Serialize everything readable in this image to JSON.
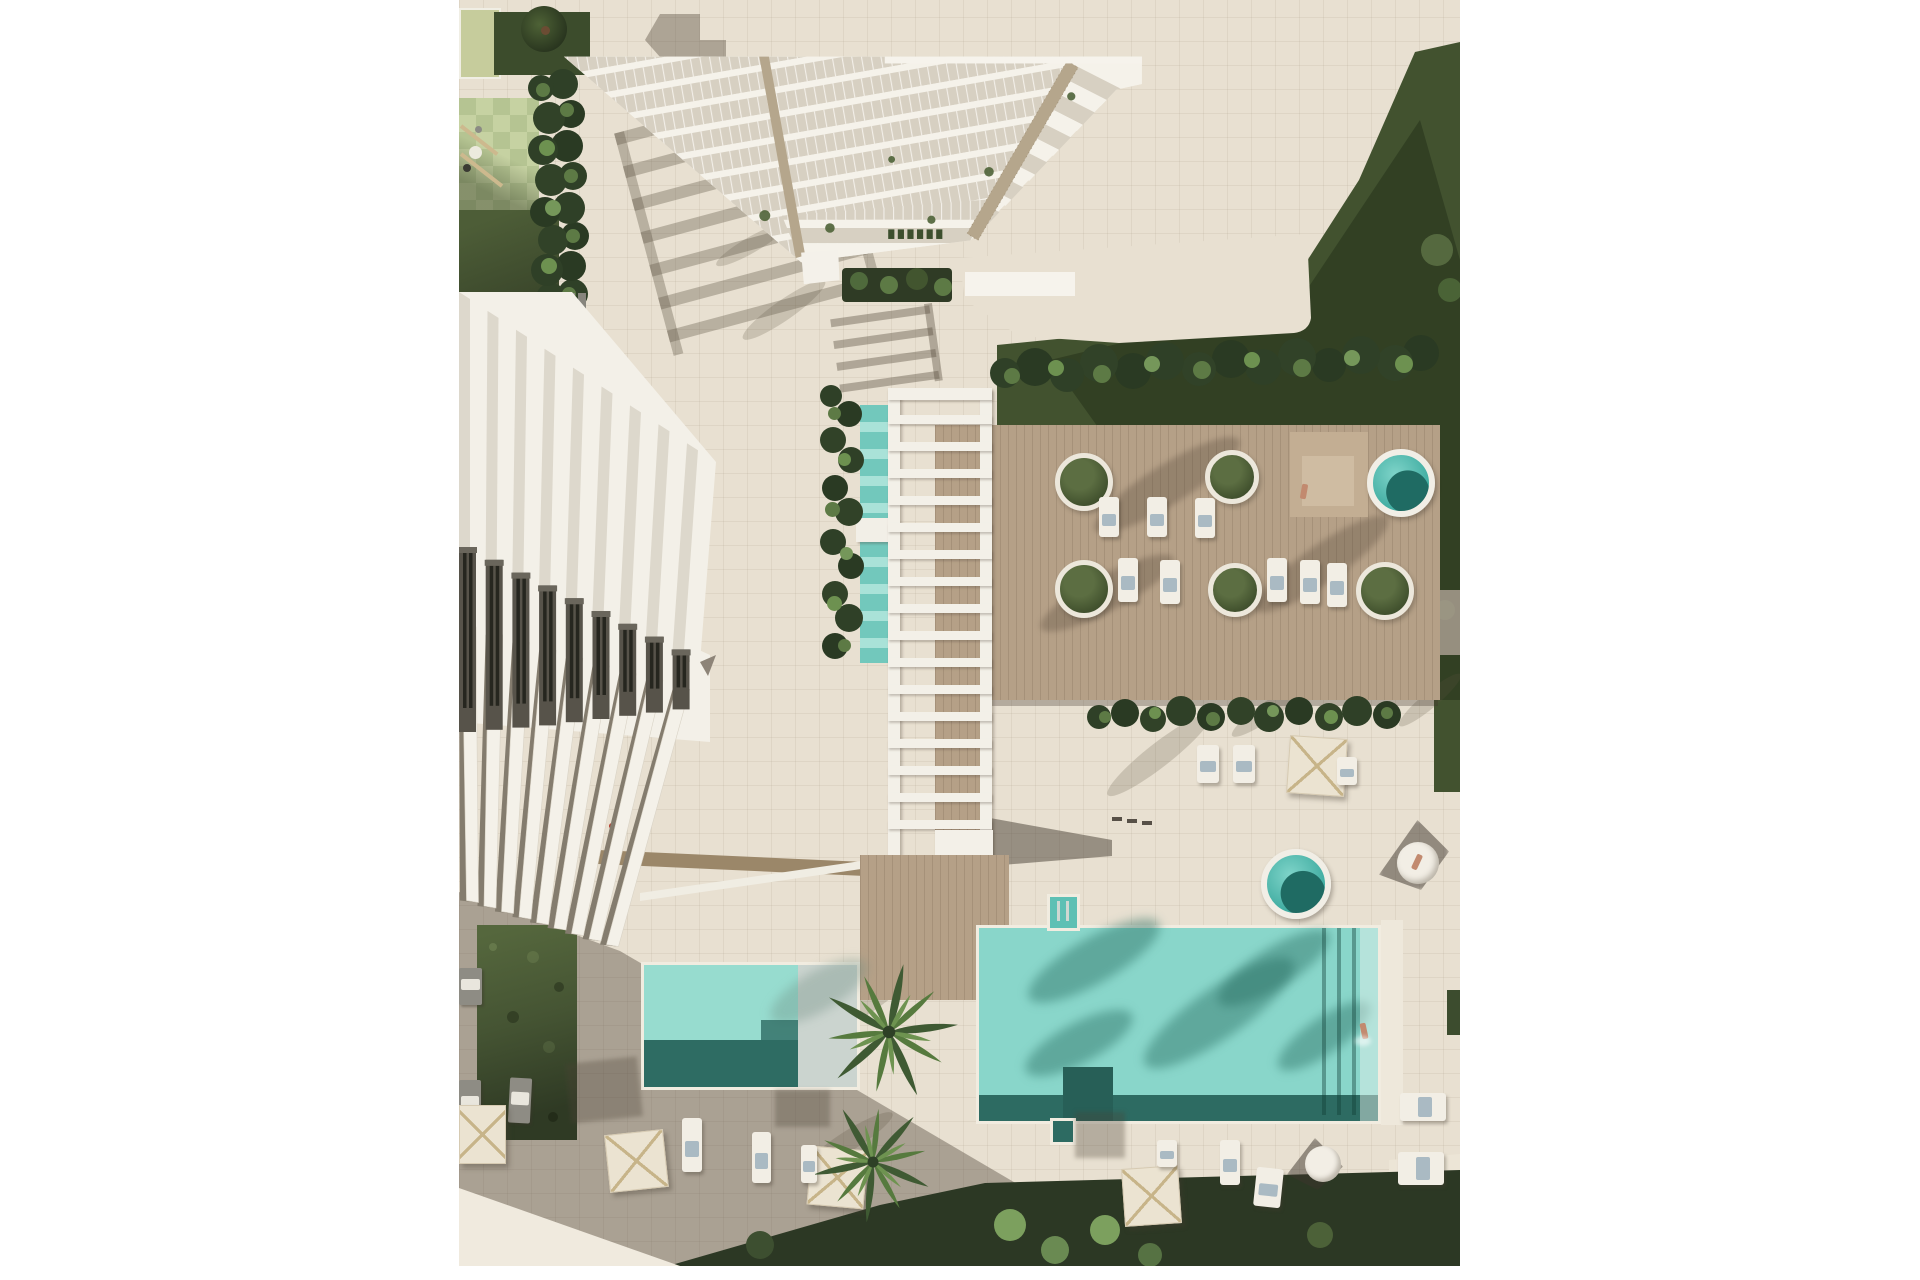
{
  "meta": {
    "type": "architectural-aerial-render",
    "description": "Top-down 3D visualization of a coastal residential complex: a white balconied tower (top), a diagonal row of white townhouses (left), a slatted pergola over a two-part lap pool (center), a wooden sun deck with round planters and plunge pools (right), a large turquoise swimming pool and a smaller kids pool (bottom), surrounded by gardens, palm trees, parasols and sun loungers.",
    "canvas": {
      "width": 1920,
      "height": 1280
    },
    "margins": "white vertical margins left and right, thin white strip at bottom"
  },
  "palette": {
    "page_background": "#ffffff",
    "paving": "#e8e0d1",
    "paving_grid": "#a89c88",
    "sunlit_path": "#f0eade",
    "cast_shadow": "#54483e",
    "deck_wood": "#b5a087",
    "path_wood": "#9b8769",
    "pool_turquoise": "#89d6ca",
    "pool_shadow_teal": "#2d6b62",
    "kids_pool": "#97dccf",
    "kids_pool_shelf": "#cbd4cf",
    "lap_pool": "#72c8bc",
    "plunge_pool": "#41ada2",
    "grass_sunlit": "#55673d",
    "grass_dark": "#2c3824",
    "hedge_dark": "#2f4027",
    "hedge_light": "#5d7a45",
    "leaf_bright": "#75975a",
    "checker_light": "#c6d2a2",
    "checker_dark": "#b5c492",
    "lime_court": "#c6cc9c",
    "building_white": "#f5f2ea",
    "glass": "#d7d0c2",
    "facade_panel": "#57534a",
    "window_slit": "#26261f",
    "timber_mast": "#b5a68c",
    "umbrella_canvas": "#ebe3d1",
    "umbrella_ribs": "#c7b489",
    "towel_blue": "#aabac3",
    "skin": "#c28a6f",
    "accent_red_toy": "#b43a2c"
  },
  "scene": {
    "buildings": [
      {
        "name": "tower",
        "style": "stepped white balconies with glass, two timber corner masts",
        "position": "top-center-right"
      },
      {
        "name": "townhouses",
        "style": "diagonal row of white units, dark facade panels, pointed gable terraces",
        "position": "left"
      }
    ],
    "water": [
      {
        "name": "main-pool",
        "color": "#89d6ca",
        "position": "bottom-right",
        "features": [
          "palm shadows",
          "ladder notches",
          "swimmer"
        ]
      },
      {
        "name": "kids-pool",
        "color": "#97dccf",
        "position": "bottom-left",
        "features": [
          "pale shallow shelf",
          "step"
        ]
      },
      {
        "name": "lap-pool",
        "color": "#72c8bc",
        "position": "center under pergola",
        "segments": 2
      },
      {
        "name": "tower-plunge-pool",
        "color": "#49bdb2",
        "position": "tower base"
      },
      {
        "name": "deck-jacuzzi",
        "color": "#41ada2",
        "position": "deck right"
      },
      {
        "name": "terrace-jacuzzi",
        "color": "#41ada2",
        "position": "below deck"
      }
    ],
    "landscape": {
      "planters_round": 5,
      "palms_large": 2,
      "umbrellas": 5,
      "sun_loungers_white": 15,
      "sun_loungers_gray": 3,
      "hedges": [
        "playground hedge column",
        "lap-pool hedge",
        "deck hedge",
        "terrace hedge",
        "bottom garden"
      ],
      "playground": "pale green checkered court with swing frame, top-left"
    },
    "people": [
      {
        "name": "swimmer",
        "location": "main pool right lane"
      },
      {
        "name": "sunbather",
        "location": "deck platform near jacuzzi"
      },
      {
        "name": "sunbather-2",
        "location": "round daybed right edge"
      }
    ]
  }
}
